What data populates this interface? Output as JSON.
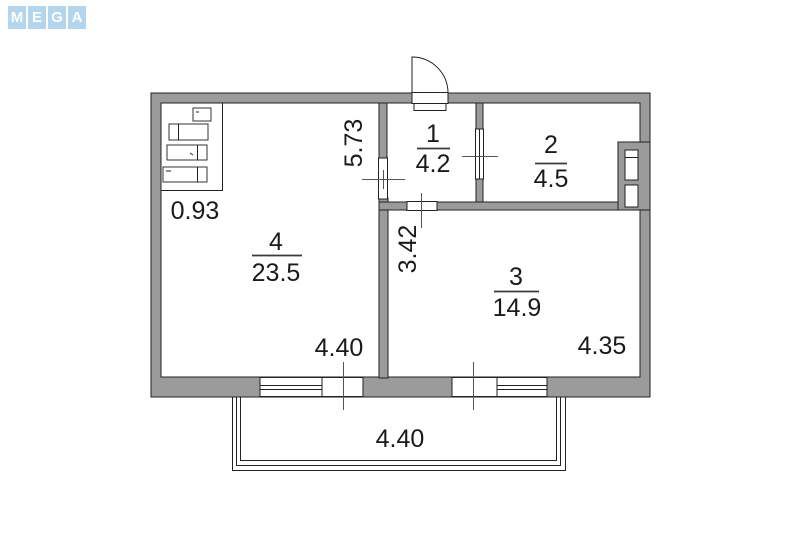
{
  "logo": {
    "letters": [
      "M",
      "E",
      "G",
      "A"
    ],
    "tile_color": "#b3d6ee",
    "letter_color": "#ffffff"
  },
  "floorplan": {
    "rooms": [
      {
        "number": "1",
        "area": "4.2"
      },
      {
        "number": "2",
        "area": "4.5"
      },
      {
        "number": "3",
        "area": "14.9"
      },
      {
        "number": "4",
        "area": "23.5"
      }
    ],
    "dimensions": {
      "closet": "0.93",
      "room4_depth": "5.73",
      "hall_depth": "3.42",
      "room4_width": "4.40",
      "room3_width": "4.35",
      "balcony_width": "4.40"
    },
    "colors": {
      "wall": "#9b9b9b",
      "outline": "#222222",
      "text": "#1a1a1a"
    }
  }
}
